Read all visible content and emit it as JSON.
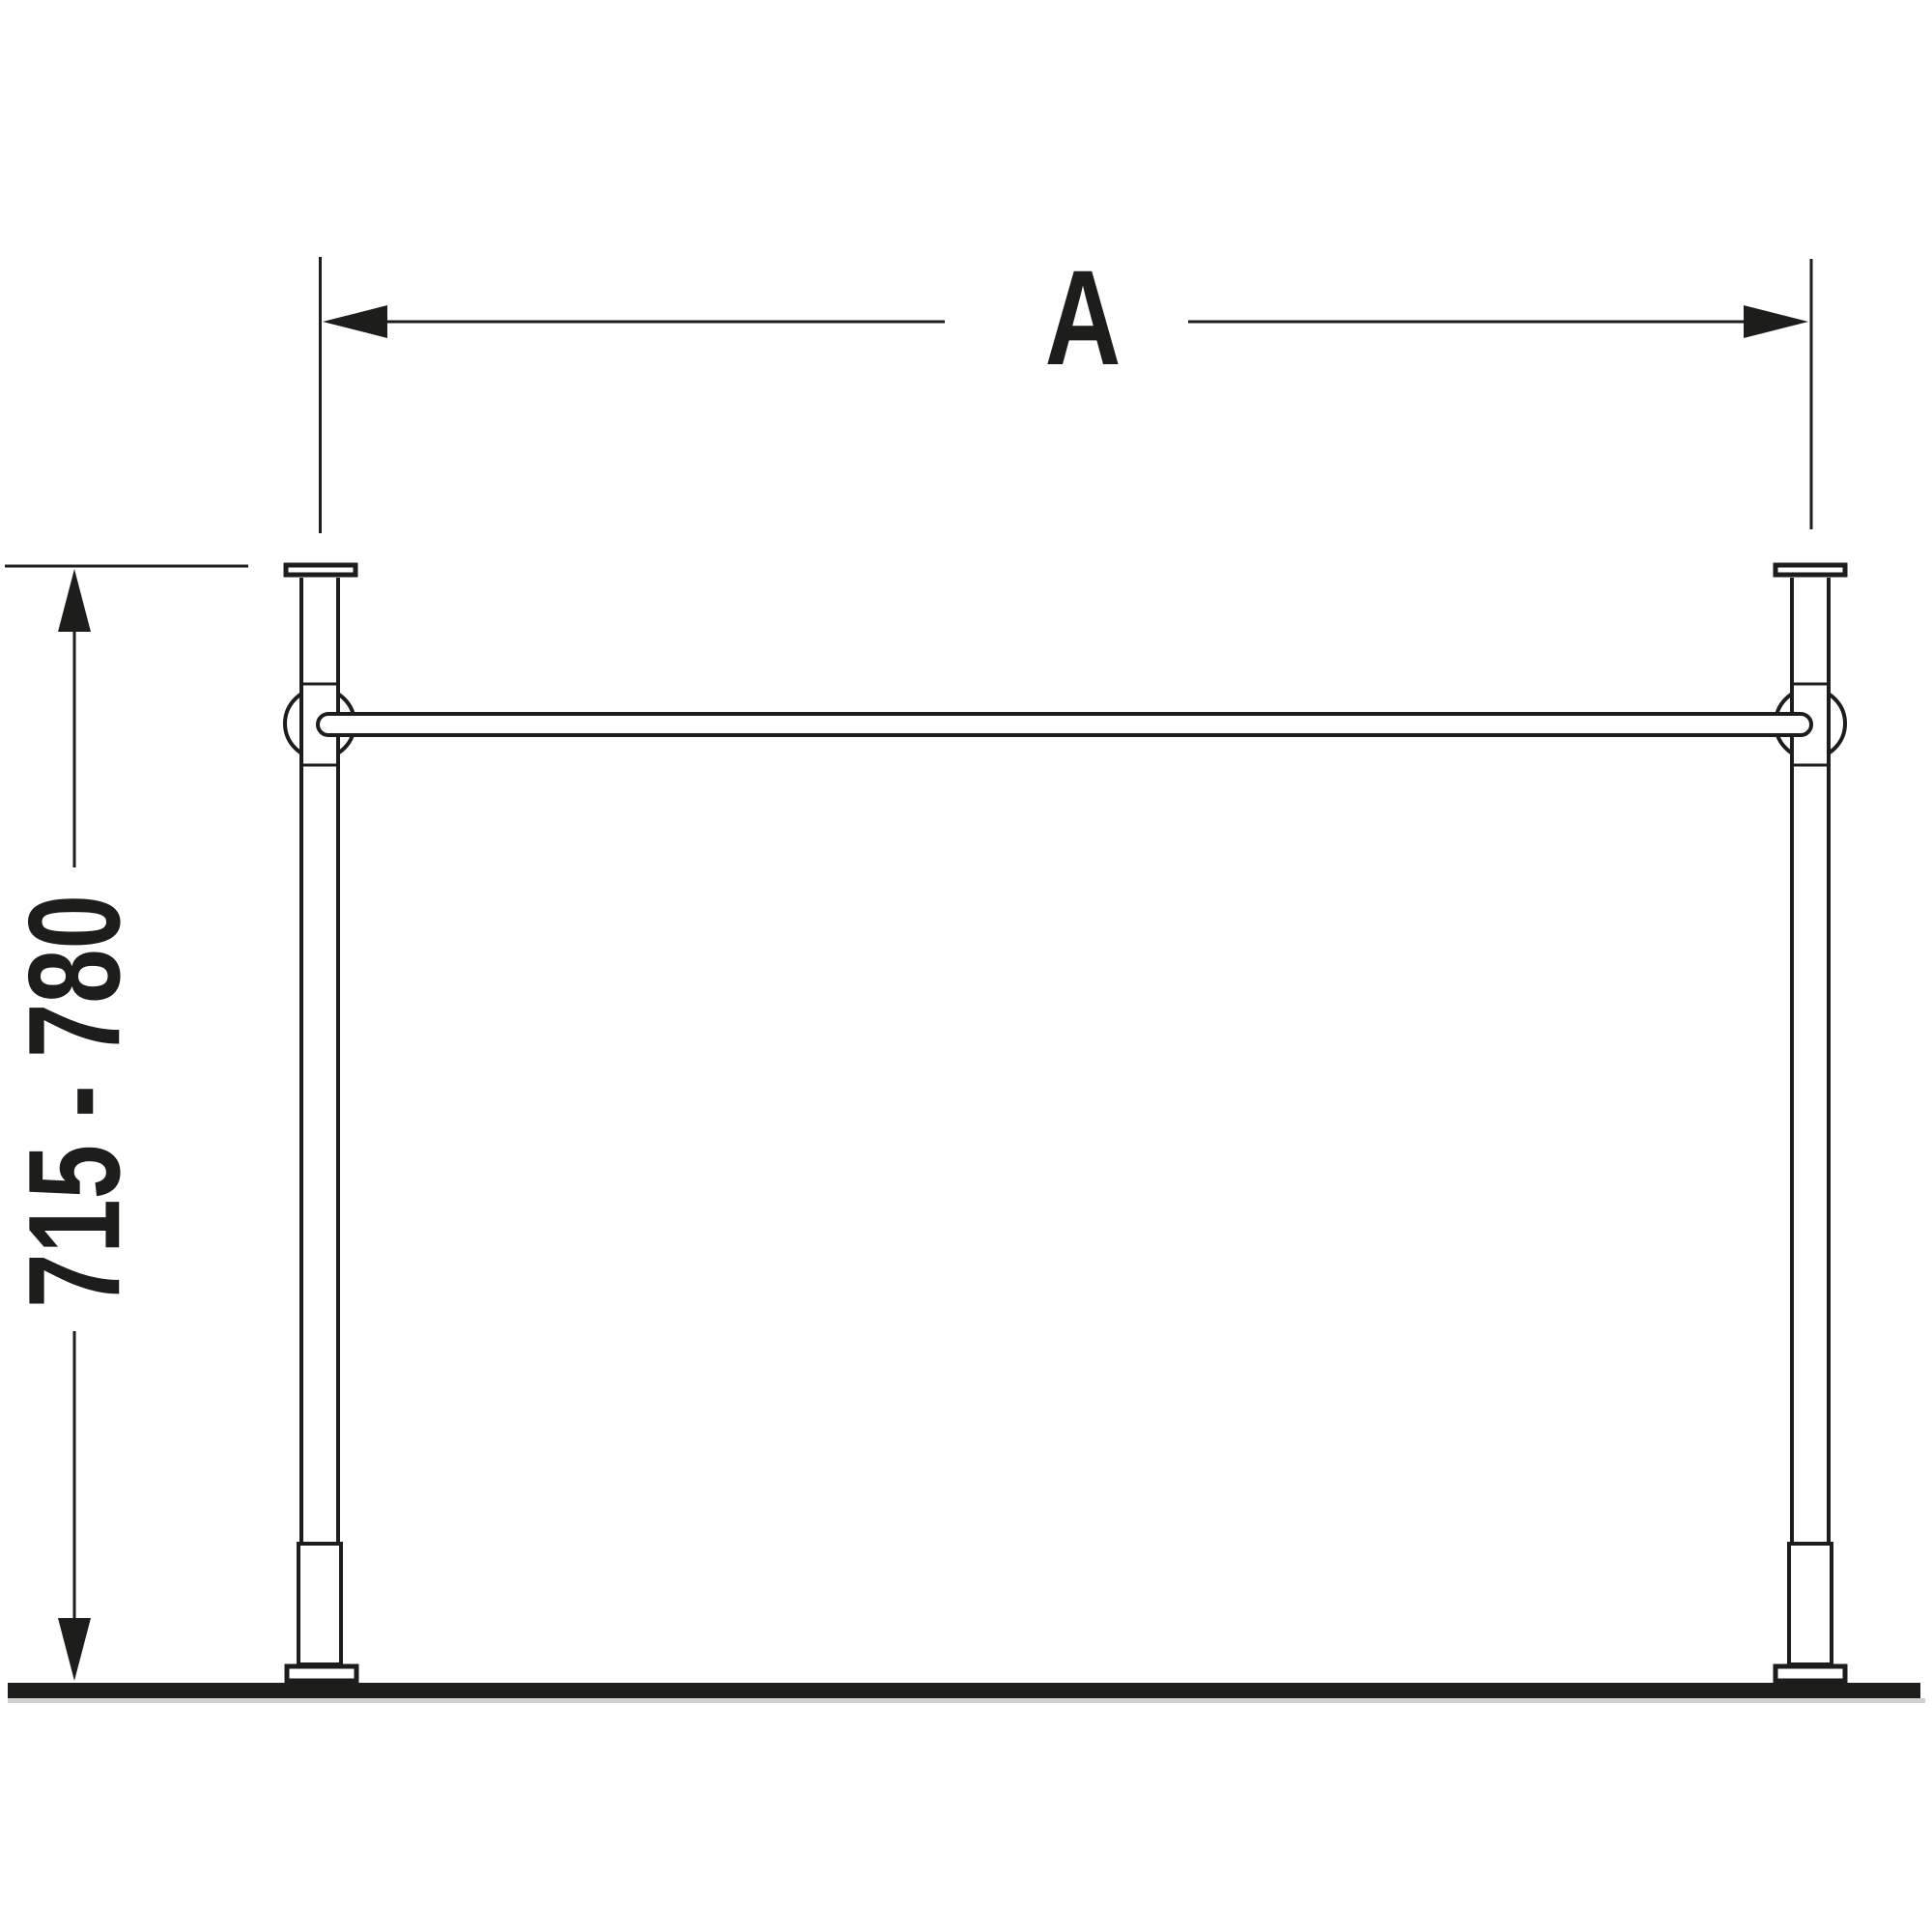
{
  "diagram": {
    "labels": {
      "width_dimension": "A",
      "height_dimension": "715 - 780"
    },
    "colors": {
      "line": "#1d1d1b",
      "floor": "#1d1d1b",
      "floor_shadow": "#cfcfcf",
      "background": "#ffffff"
    }
  }
}
